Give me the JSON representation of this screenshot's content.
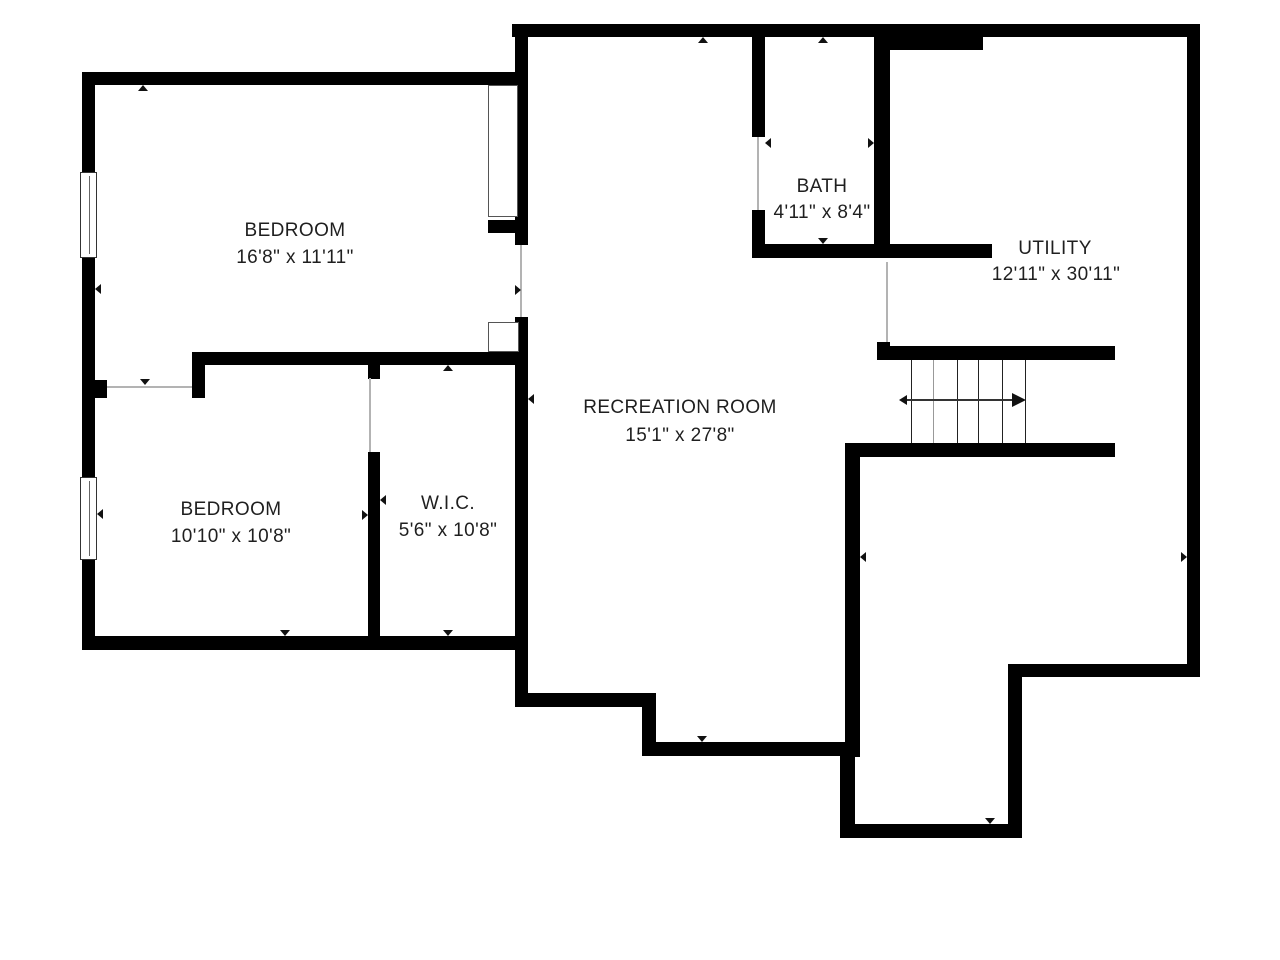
{
  "plan": {
    "title": "Basement floor plan",
    "colors": {
      "wall": "#000000",
      "background": "#ffffff",
      "opening_line": "#b3b3b3",
      "text": "#1f1f1f"
    },
    "rooms": [
      {
        "name": "BEDROOM",
        "dims": "16'8\" x 11'11\""
      },
      {
        "name": "BEDROOM",
        "dims": "10'10\" x 10'8\""
      },
      {
        "name": "W.I.C.",
        "dims": "5'6\" x 10'8\""
      },
      {
        "name": "RECREATION ROOM",
        "dims": "15'1\" x 27'8\""
      },
      {
        "name": "BATH",
        "dims": "4'11\" x 8'4\""
      },
      {
        "name": "UTILITY",
        "dims": "12'11\" x 30'11\""
      }
    ],
    "stairs": {
      "steps": 6,
      "direction": "right"
    }
  }
}
